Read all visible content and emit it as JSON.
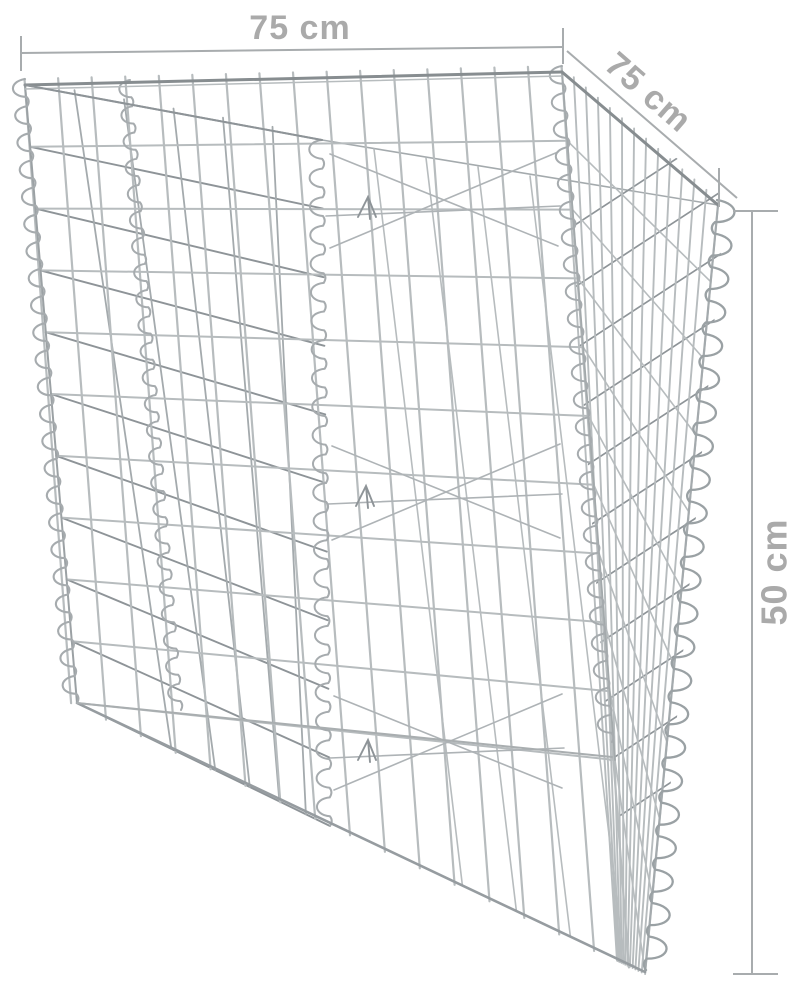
{
  "figure": {
    "subject": "triangular gabion wire basket raised planter shown in perspective with measurement lines"
  },
  "dimensions": {
    "width": {
      "label": "75 cm",
      "value": 75,
      "unit": "cm",
      "orientation": "horizontal-top"
    },
    "depth": {
      "label": "75 cm",
      "value": 75,
      "unit": "cm",
      "orientation": "diagonal-right"
    },
    "height": {
      "label": "50 cm",
      "value": 50,
      "unit": "cm",
      "orientation": "vertical-right"
    }
  },
  "colors": {
    "background": "#ffffff",
    "dimension_text": "#aaaaaa",
    "dimension_line": "#a8acae",
    "wire_light": "#b7bcbe",
    "wire_medium": "#a4aaad",
    "wire_dark": "#8e9498",
    "wire_rim": "#878d90",
    "spiral": "#a6abae"
  }
}
